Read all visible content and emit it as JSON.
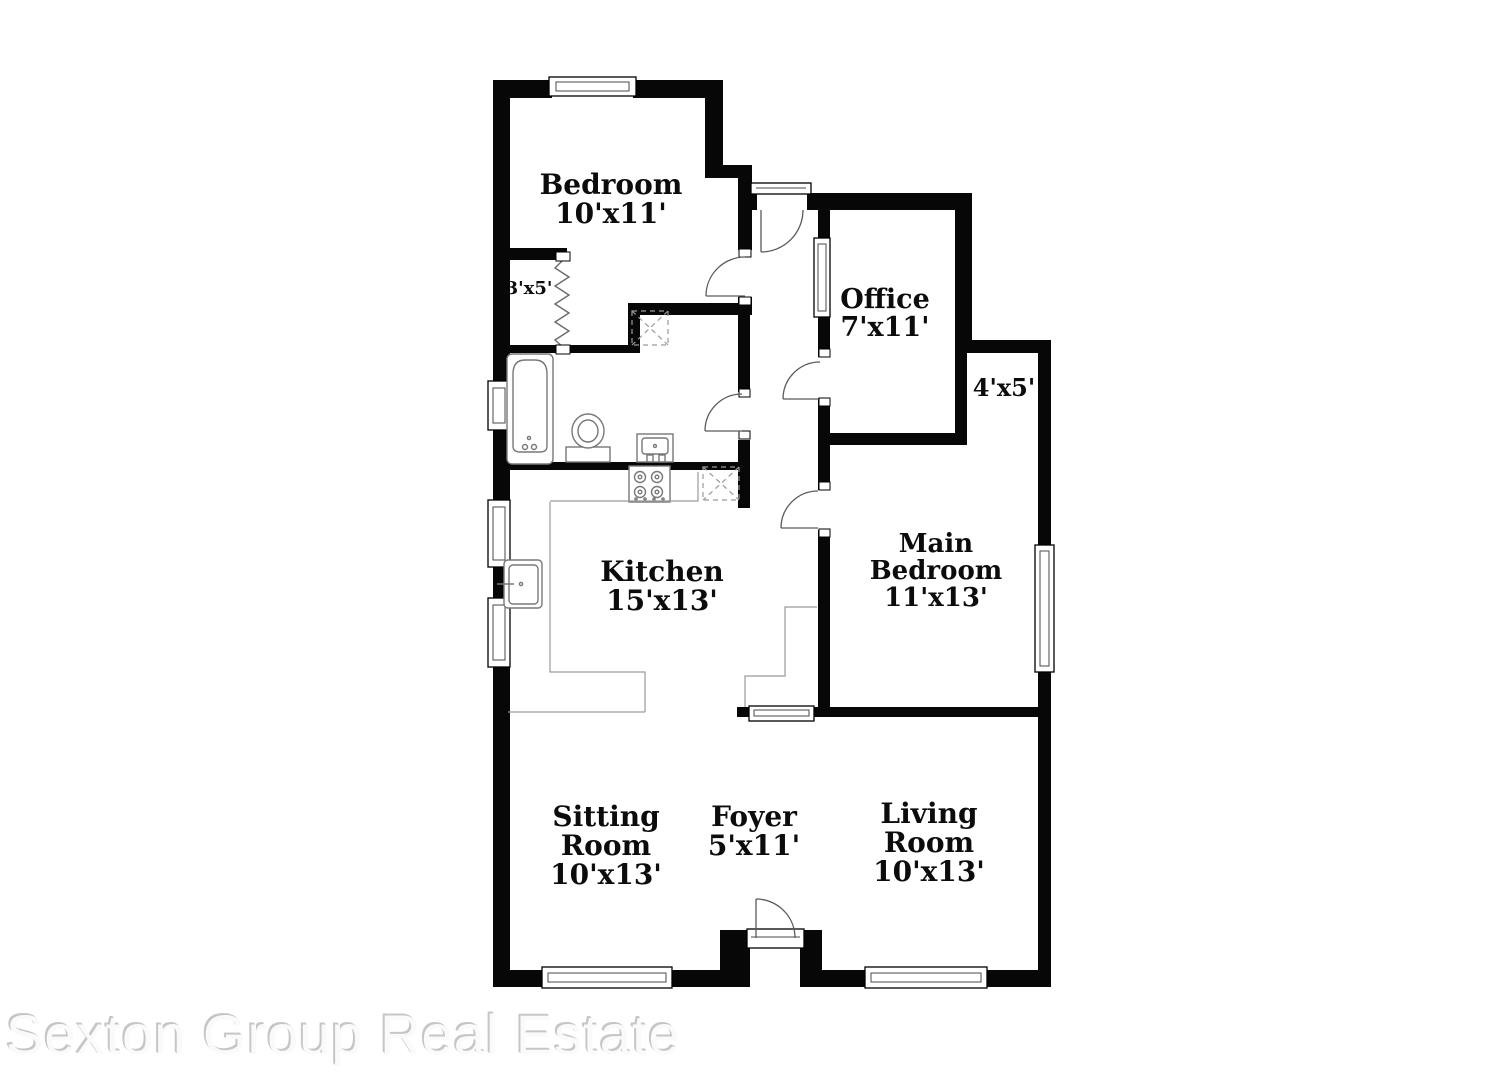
{
  "rooms": {
    "bedroom": {
      "name": "Bedroom",
      "dims": "10'x11'"
    },
    "closet": {
      "dims": "3'x5'"
    },
    "office": {
      "name": "Office",
      "dims": "7'x11'"
    },
    "nook": {
      "dims": "4'x5'"
    },
    "kitchen": {
      "name": "Kitchen",
      "dims": "15'x13'"
    },
    "main_bedroom": {
      "line1": "Main",
      "line2": "Bedroom",
      "dims": "11'x13'"
    },
    "sitting_room": {
      "line1": "Sitting",
      "line2": "Room",
      "dims": "10'x13'"
    },
    "foyer": {
      "name": "Foyer",
      "dims": "5'x11'"
    },
    "living_room": {
      "line1": "Living",
      "line2": "Room",
      "dims": "10'x13'"
    }
  },
  "watermark": {
    "text": "Sexton Group Real Estate"
  },
  "colors": {
    "wall": "#070707",
    "fixture_line": "#787878",
    "watermark_gray": "#c6c6c6"
  }
}
